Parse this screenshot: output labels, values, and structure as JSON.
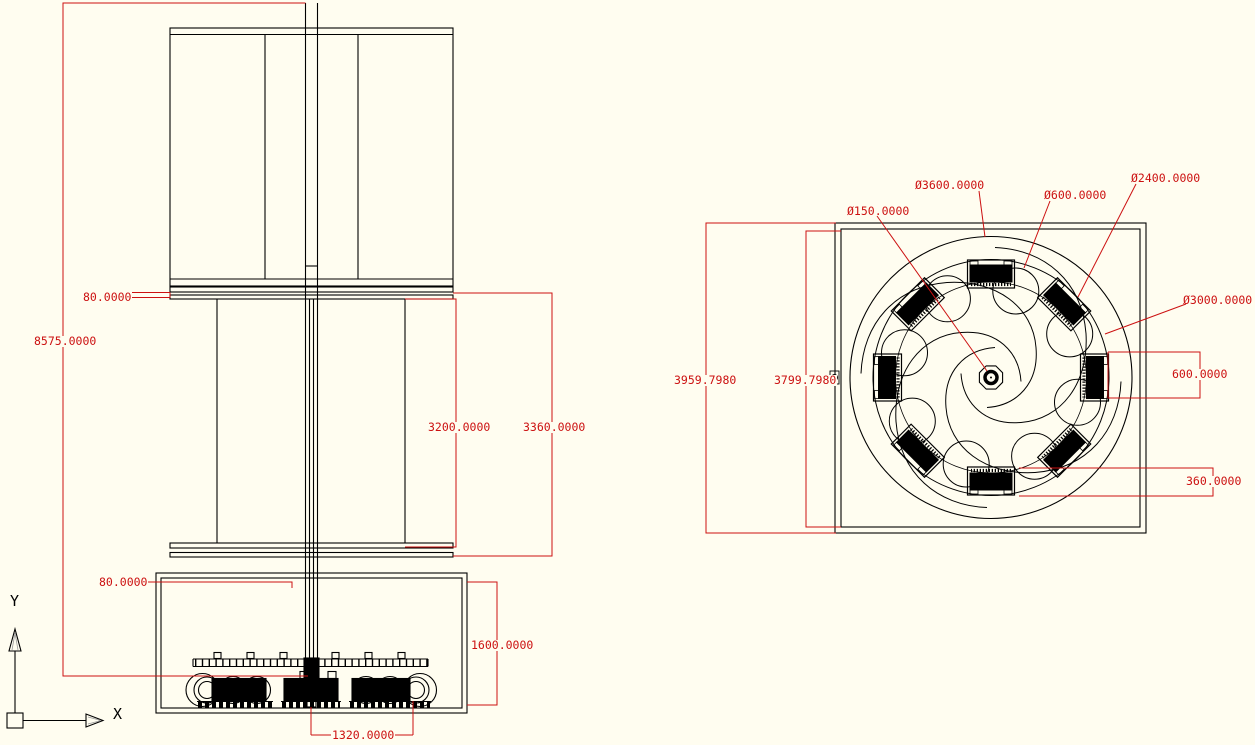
{
  "colors": {
    "paper": "#fffdf0",
    "linework": "#000000",
    "dimension": "#cc1111"
  },
  "front_view": {
    "dims": {
      "total_height": "8575.0000",
      "top_plate_thickness": "80.0000",
      "rotor_inner_height": "3200.0000",
      "rotor_outer_height": "3360.0000",
      "base_plate_thickness": "80.0000",
      "base_box_height": "1600.0000",
      "generator_spacing": "1320.0000"
    }
  },
  "plan_view": {
    "dims": {
      "overall_width": "3959.7980",
      "frame_inner_width": "3799.7980",
      "blade_length": "600.0000",
      "blade_width": "360.0000"
    },
    "diameters": {
      "outer_circle": "Ø3600.0000",
      "pocket_circle": "Ø600.0000",
      "blade_circle": "Ø2400.0000",
      "hub": "Ø150.0000",
      "inner_circle": "Ø3000.0000"
    }
  },
  "ucs": {
    "x_label": "X",
    "y_label": "Y"
  }
}
